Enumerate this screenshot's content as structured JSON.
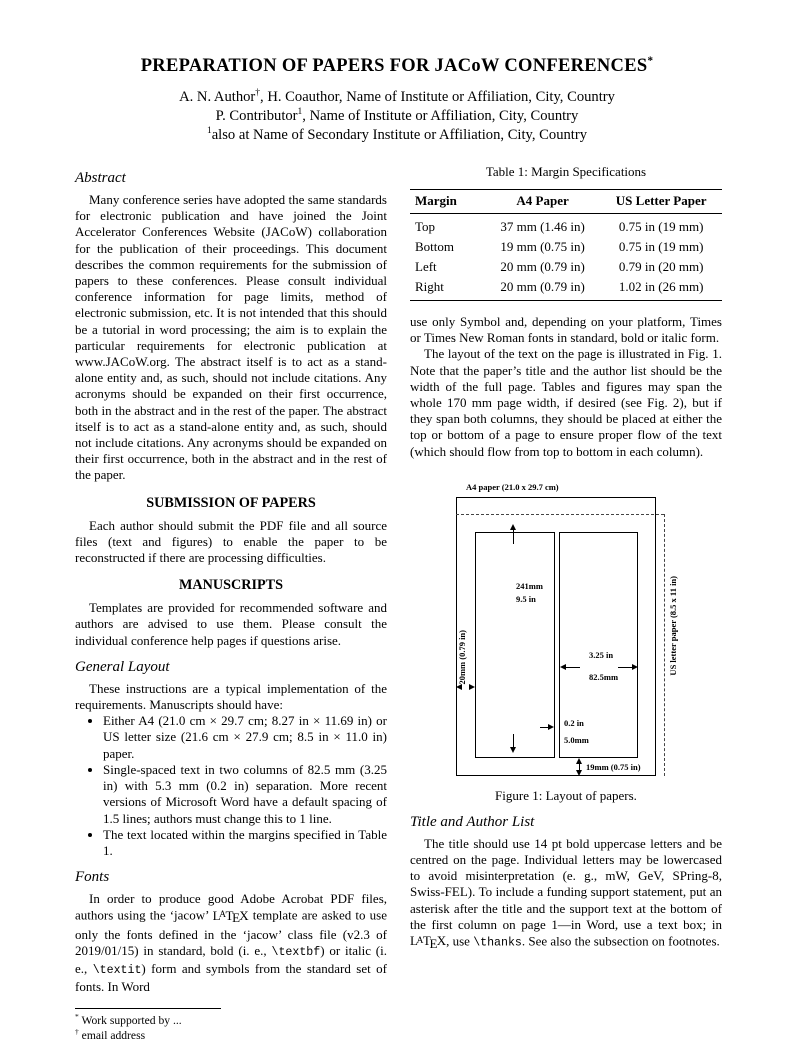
{
  "header": {
    "title": "PREPARATION OF PAPERS FOR JACoW CONFERENCES",
    "title_sup": "*",
    "authors": [
      {
        "a": "A. N. Author",
        "sup": "†",
        "b": ", H. Coauthor, Name of Institute or Affiliation, City, Country"
      },
      {
        "a": "P. Contributor",
        "sup": "1",
        "b": ", Name of Institute or Affiliation, City, Country"
      },
      {
        "a": "",
        "sup": "1",
        "b": "also at Name of Secondary Institute or Affiliation, City, Country"
      }
    ]
  },
  "latex_logo": {
    "l": "L",
    "a": "A",
    "t": "T",
    "e": "E",
    "x": "X"
  },
  "left": {
    "abstract_heading": "Abstract",
    "abstract_text": "Many conference series have adopted the same standards for electronic publication and have joined the Joint Accelerator Conferences Website (JACoW) collaboration for the publication of their proceedings. This document describes the common requirements for the submission of papers to these conferences. Please consult individual conference information for page limits, method of electronic submission, etc. It is not intended that this should be a tutorial in word processing; the aim is to explain the particular requirements for electronic publication at www.JACoW.org. The abstract itself is to act as a stand-alone entity and, as such, should not include citations. Any acronyms should be expanded on their first occurrence, both in the abstract and in the rest of the paper. The abstract itself is to act as a stand-alone entity and, as such, should not include citations. Any acronyms should be expanded on their first occurrence, both in the abstract and in the rest of the paper.",
    "submission_heading": "SUBMISSION OF PAPERS",
    "submission_text": "Each author should submit the PDF file and all source files (text and figures) to enable the paper to be reconstructed if there are processing difficulties.",
    "manuscripts_heading": "MANUSCRIPTS",
    "manuscripts_text": "Templates are provided for recommended software and authors are advised to use them. Please consult the individual conference help pages if questions arise.",
    "general_layout_heading": "General Layout",
    "general_layout_intro": "These instructions are a typical implementation of the requirements. Manuscripts should have:",
    "bullets": [
      "Either A4 (21.0 cm × 29.7 cm; 8.27 in × 11.69 in) or US letter size (21.6 cm × 27.9 cm; 8.5 in × 11.0 in) paper.",
      "Single-spaced text in two columns of 82.5 mm (3.25 in) with 5.3 mm (0.2 in) separation. More recent versions of Microsoft Word have a default spacing of 1.5 lines; authors must change this to 1 line.",
      "The text located within the margins specified in Table 1."
    ],
    "fonts_heading": "Fonts",
    "fonts": {
      "p1": "In order to produce good Adobe Acrobat PDF files, authors using the ‘jacow’ ",
      "p2": " template are asked to use only the fonts defined in the ‘jacow’ class file (v2.3 of 2019/01/15) in standard, bold (i. e., ",
      "code1": "\\textbf",
      "p3": ") or italic (i. e., ",
      "code2": "\\textit",
      "p4": ") form and symbols from the standard set of fonts. In Word"
    },
    "footnotes": [
      {
        "sym": "*",
        "text": "Work supported by ..."
      },
      {
        "sym": "†",
        "text": "email address"
      }
    ]
  },
  "right": {
    "table": {
      "caption": "Table 1: Margin Specifications",
      "headers": [
        "Margin",
        "A4 Paper",
        "US Letter Paper"
      ],
      "rows": [
        [
          "Top",
          "37 mm (1.46 in)",
          "0.75 in (19 mm)"
        ],
        [
          "Bottom",
          "19 mm (0.75 in)",
          "0.75 in (19 mm)"
        ],
        [
          "Left",
          "20 mm (0.79 in)",
          "0.79 in (20 mm)"
        ],
        [
          "Right",
          "20 mm (0.79 in)",
          "1.02 in (26 mm)"
        ]
      ]
    },
    "para1": "use only Symbol and, depending on your platform, Times or Times New Roman fonts in standard, bold or italic form.",
    "para2": "The layout of the text on the page is illustrated in Fig. 1. Note that the paper’s title and the author list should be the width of the full page. Tables and figures may span the whole 170 mm page width, if desired (see Fig. 2), but if they span both columns, they should be placed at either the top or bottom of a page to ensure proper flow of the text (which should flow from top to bottom in each column).",
    "figure": {
      "paper_label": "A4 paper (21.0 x 29.7 cm)",
      "col_height_line1": "241mm",
      "col_height_line2": "9.5 in",
      "left_margin_label": "20mm (0.79 in)",
      "col_width_line1": "3.25 in",
      "col_width_line2": "82.5mm",
      "gap_line1": "0.2 in",
      "gap_line2": "5.0mm",
      "bottom_margin_label": "19mm (0.75 in)",
      "us_letter_label": "US letter paper (8.5 x 11 in)",
      "caption": "Figure 1: Layout of papers."
    },
    "title_author_heading": "Title and Author List",
    "title_author": {
      "p1": "The title should use 14 pt bold uppercase letters and be centred on the page. Individual letters may be lowercased to avoid misinterpretation (e. g., mW, GeV, SPring-8, Swiss-FEL). To include a funding support statement, put an asterisk after the title and the support text at the bottom of the first column on page 1—in Word, use a text box; in ",
      "p2": ", use ",
      "code": "\\thanks",
      "p3": ". See also the subsection on footnotes."
    }
  },
  "colors": {
    "text": "#000000",
    "background": "#ffffff"
  }
}
